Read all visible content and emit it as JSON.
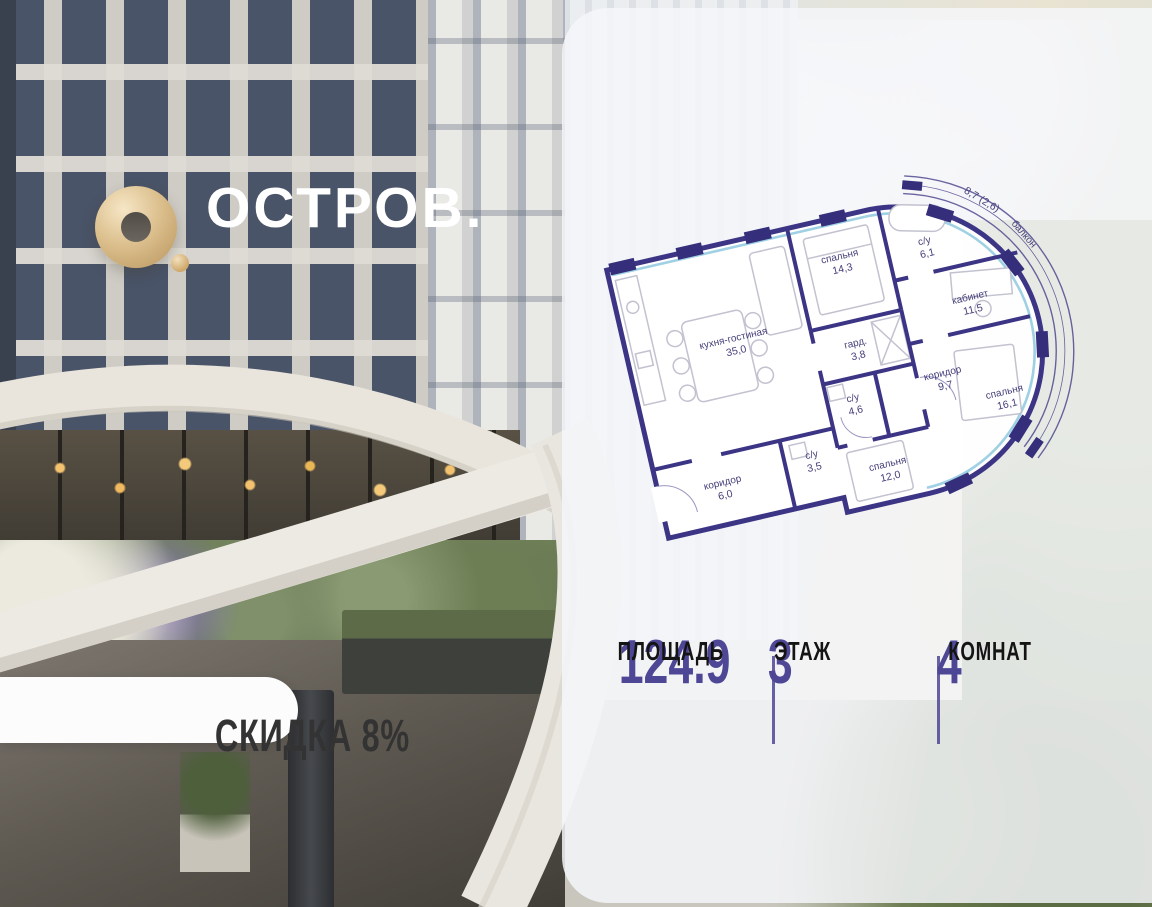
{
  "brand": {
    "wordmark": "ОСТРОВ.",
    "mark": "О."
  },
  "badge": {
    "label": "СКИДКА 8%"
  },
  "floorplan": {
    "rooms": [
      {
        "name": "кухня-гостиная",
        "area": "35,0"
      },
      {
        "name": "спальня",
        "area": "14,3"
      },
      {
        "name": "с/у",
        "area": "6,1"
      },
      {
        "name": "кабинет",
        "area": "11,5"
      },
      {
        "name": "гард.",
        "area": "3,8"
      },
      {
        "name": "коридор",
        "area": "9,7"
      },
      {
        "name": "спальня",
        "area": "16,1"
      },
      {
        "name": "с/у",
        "area": "4,6"
      },
      {
        "name": "с/у",
        "area": "3,5"
      },
      {
        "name": "коридор",
        "area": "6,0"
      },
      {
        "name": "спальня",
        "area": "12,0"
      },
      {
        "name": "балкон",
        "area": "8,7 (2,6)"
      }
    ]
  },
  "stats": [
    {
      "value": "124.9",
      "label": "ПЛОЩАДЬ"
    },
    {
      "value": "3",
      "label": "ЭТАЖ"
    },
    {
      "value": "4",
      "label": "КОМНАТ"
    }
  ],
  "colors": {
    "accent": "#4e4795",
    "plan_wall": "#3c3484",
    "glazing": "#9fd0e4",
    "logo_gold": "#cfa86b"
  }
}
